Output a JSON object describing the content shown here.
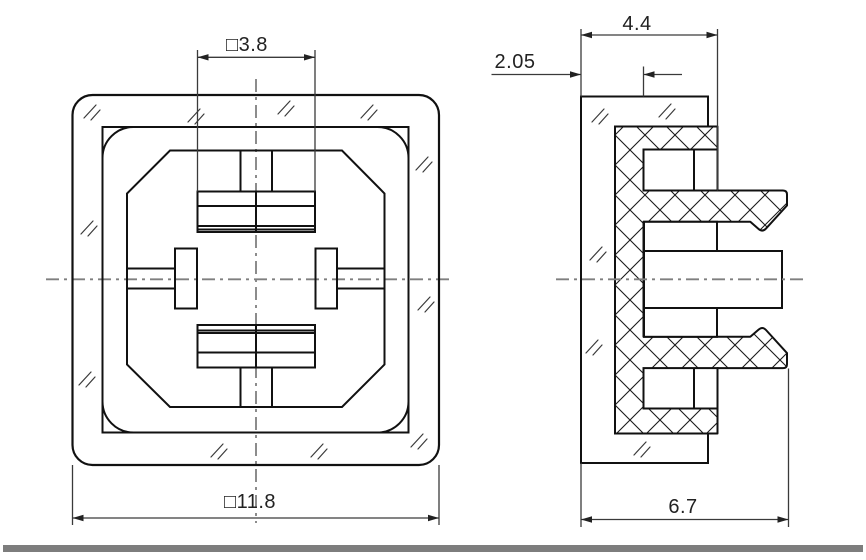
{
  "drawing": {
    "title": "connector-two-view-technical-drawing",
    "background": "#ffffff",
    "colors": {
      "outline": "#111111",
      "thin_lines": "#3a3a3a",
      "centerline": "#7f7f7f",
      "hatch": "#1a1a1a",
      "footer_bar": "#7d7d7d"
    },
    "views": {
      "front_view": {
        "description": "front-view"
      },
      "side_view": {
        "description": "side-section-view"
      }
    },
    "dimensions": {
      "slot_width": "□3.8",
      "body_width": "□11.8",
      "flange_depth": "4.4",
      "panel_offset": "2.05",
      "total_depth": "6.7"
    }
  }
}
